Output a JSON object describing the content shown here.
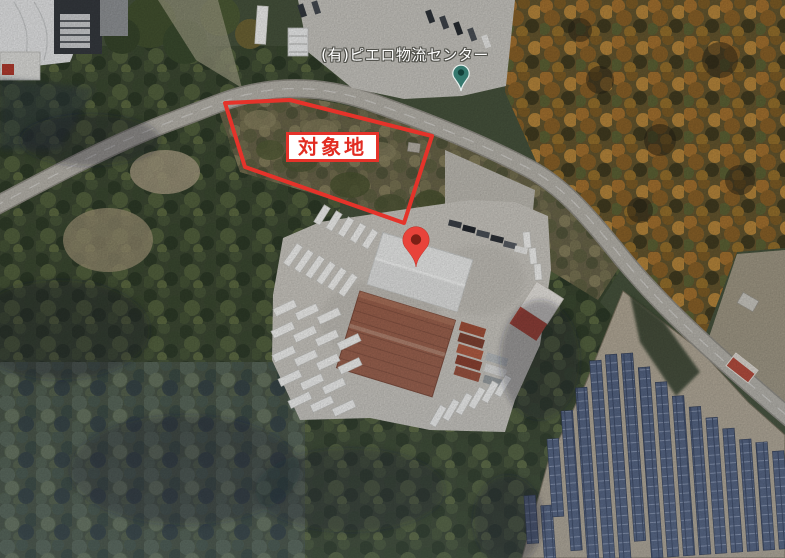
{
  "map": {
    "view": "satellite",
    "poi": {
      "label": "(有)ピエロ物流センター",
      "pin_icon": "place-pin-icon",
      "pin_color": "#35786e",
      "pin_inner_color": "#123f39"
    },
    "annotations": {
      "target_area": {
        "label": "対象地",
        "outline_color": "#e5332a",
        "label_text_color": "#e22c22",
        "label_background": "#ffffff"
      },
      "marker": {
        "icon": "red-map-pin-icon",
        "color": "#e8433a",
        "inner_color": "#7c1f15"
      }
    }
  }
}
